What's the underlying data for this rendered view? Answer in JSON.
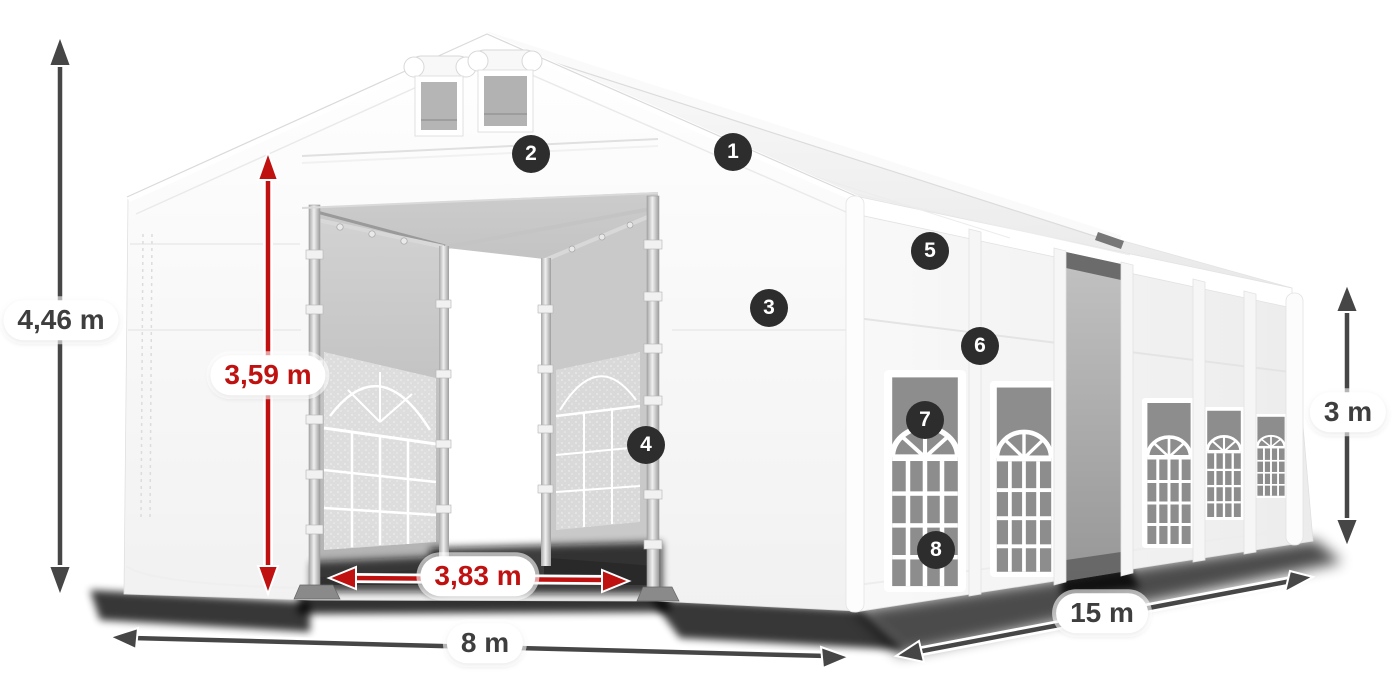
{
  "dimensions": {
    "total_height": "4,46 m",
    "entrance_height": "3,59 m",
    "entrance_width": "3,83 m",
    "front_width": "8 m",
    "side_length": "15 m",
    "wall_height": "3 m"
  },
  "markers": [
    "1",
    "2",
    "3",
    "4",
    "5",
    "6",
    "7",
    "8"
  ],
  "colors": {
    "dimension_red": "#c01111",
    "dimension_dark": "#464646",
    "label_text_dark": "#3e3e3e",
    "pill_bg": "#ffffff",
    "marker_bg": "#2d2d2d",
    "marker_text": "#ffffff",
    "canvas_bg": "#ffffff",
    "tent_fabric": "#f7f7f7",
    "interior_grey": "#b0b0b0"
  }
}
